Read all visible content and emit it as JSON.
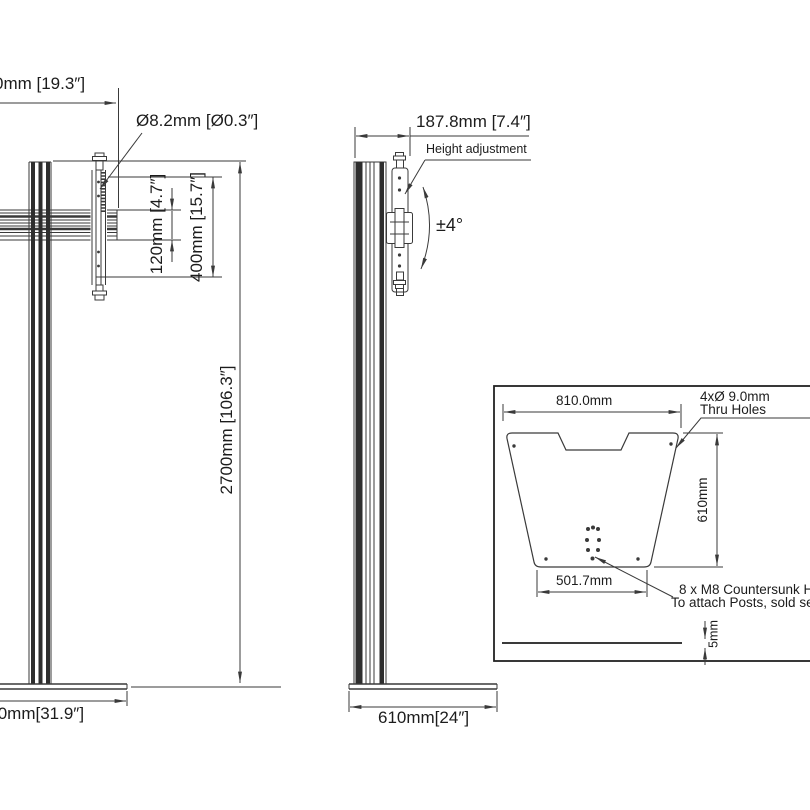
{
  "colors": {
    "line": "#3a3a3a",
    "dark_fill": "#2e2e2e",
    "text": "#1c1c1c",
    "background": "#ffffff"
  },
  "front_view": {
    "dim_width_top": "0mm [19.3″]",
    "hole_dia_label": "Ø8.2mm [Ø0.3″]",
    "dim_120": "120mm [4.7″]",
    "dim_400": "400mm [15.7″]",
    "dim_height": "2700mm [106.3″]",
    "dim_base_width": ".0mm[31.9″]"
  },
  "side_view": {
    "dim_depth": "187.8mm [7.4″]",
    "height_adjustment_label": "Height adjustment",
    "tilt_label": "±4°",
    "dim_base_depth": "610mm[24″]"
  },
  "inset": {
    "dim_plate_width": "810.0mm",
    "thru_holes_line1": "4xØ 9.0mm",
    "thru_holes_line2": "Thru Holes",
    "dim_plate_depth": "610mm",
    "dim_hole_span": "501.7mm",
    "countersunk_line1": "8 x M8 Countersunk Holes",
    "countersunk_line2": "To attach Posts, sold separately",
    "dim_thickness": "5mm"
  }
}
